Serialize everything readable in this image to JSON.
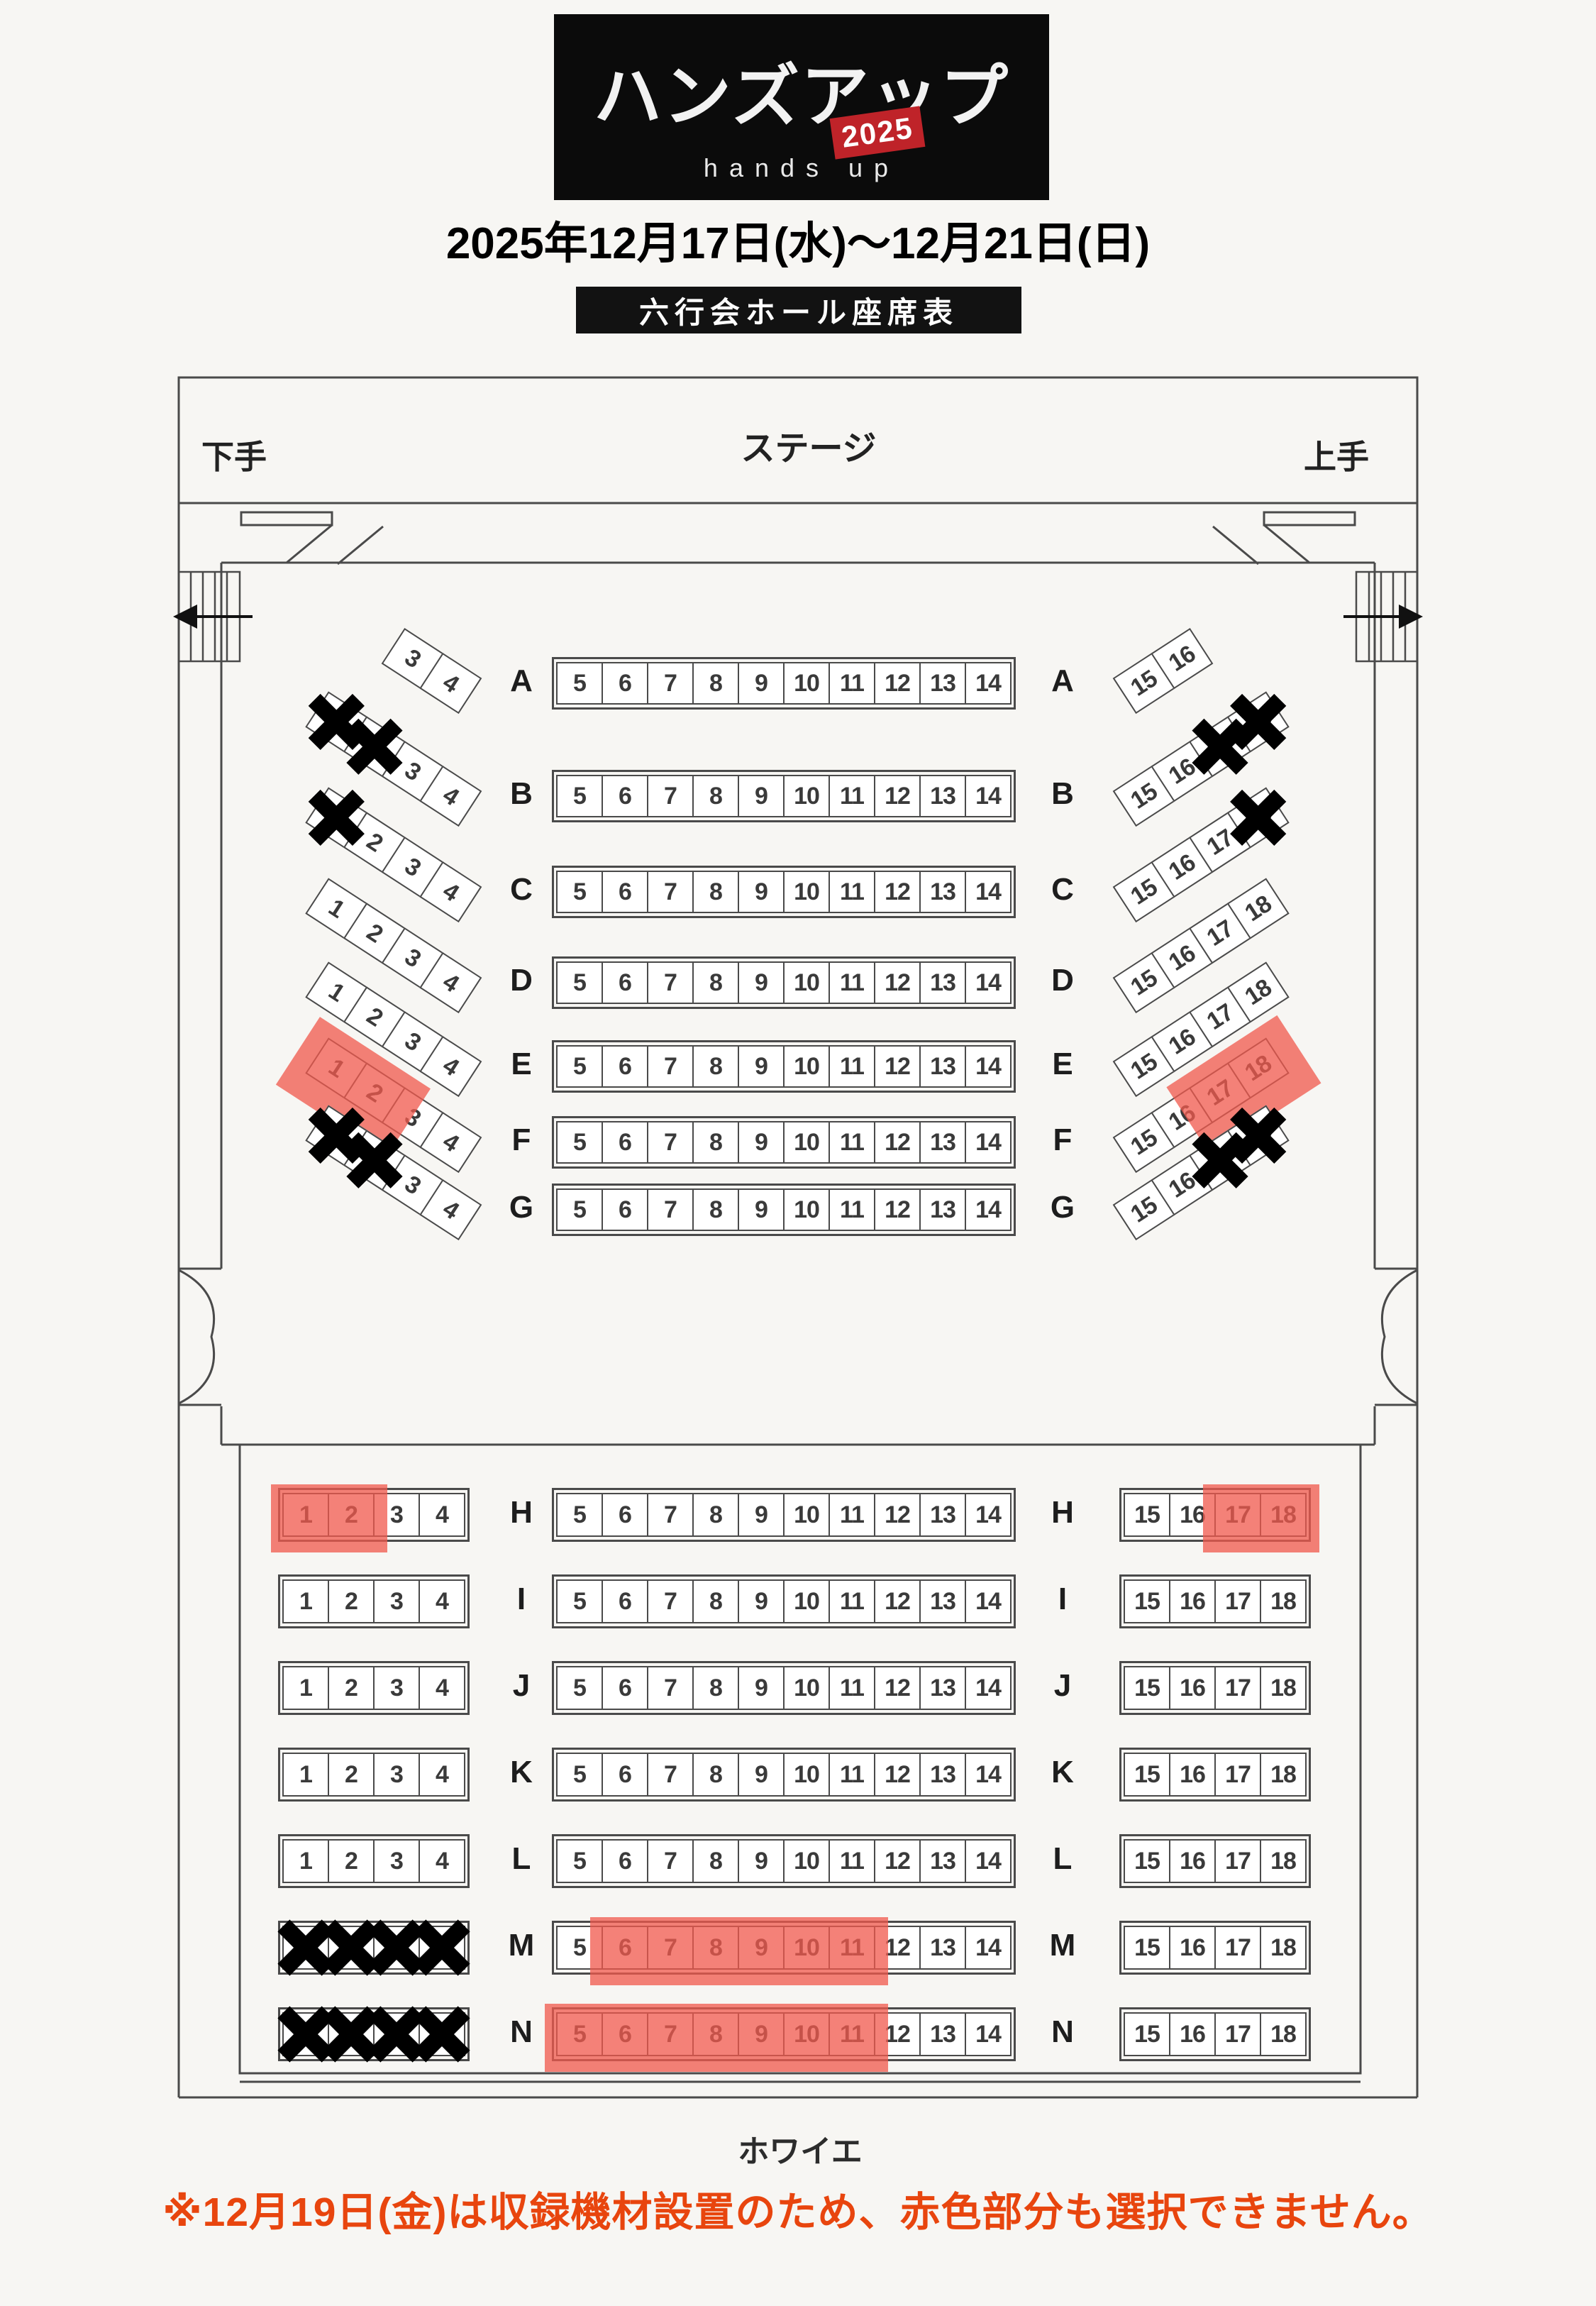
{
  "header": {
    "logo_title": "ハンズアップ",
    "logo_year": "2025",
    "logo_subtitle": "hands up",
    "dates": "2025年12月17日(水)〜12月21日(日)",
    "hall_banner": "六行会ホール座席表"
  },
  "stage": {
    "label": "ステージ",
    "left_wing": "下手",
    "right_wing": "上手"
  },
  "foyer_label": "ホワイエ",
  "note": "※12月19日(金)は収録機材設置のため、赤色部分も選択できません。",
  "colors": {
    "restricted_highlight": "#f05a4e",
    "note_text": "#e8450e",
    "badge_red": "#bf2329",
    "line": "#4a4a4a"
  },
  "icons": {
    "left_exit": "exit-arrow-left-icon",
    "right_exit": "exit-arrow-right-icon",
    "unavailable": "cross-x-icon"
  },
  "state_legend": {
    "o": "open",
    "x": "unavailable",
    "r": "restricted-on-12-19"
  },
  "sections": {
    "upper": {
      "rows": [
        {
          "label": "A",
          "left": [
            [
              "3",
              "o"
            ],
            [
              "4",
              "o"
            ]
          ],
          "center": [
            [
              "5",
              "o"
            ],
            [
              "6",
              "o"
            ],
            [
              "7",
              "o"
            ],
            [
              "8",
              "o"
            ],
            [
              "9",
              "o"
            ],
            [
              "10",
              "o"
            ],
            [
              "11",
              "o"
            ],
            [
              "12",
              "o"
            ],
            [
              "13",
              "o"
            ],
            [
              "14",
              "o"
            ]
          ],
          "right": [
            [
              "15",
              "o"
            ],
            [
              "16",
              "o"
            ]
          ]
        },
        {
          "label": "B",
          "left": [
            [
              "1",
              "x"
            ],
            [
              "2",
              "x"
            ],
            [
              "3",
              "o"
            ],
            [
              "4",
              "o"
            ]
          ],
          "center": [
            [
              "5",
              "o"
            ],
            [
              "6",
              "o"
            ],
            [
              "7",
              "o"
            ],
            [
              "8",
              "o"
            ],
            [
              "9",
              "o"
            ],
            [
              "10",
              "o"
            ],
            [
              "11",
              "o"
            ],
            [
              "12",
              "o"
            ],
            [
              "13",
              "o"
            ],
            [
              "14",
              "o"
            ]
          ],
          "right": [
            [
              "15",
              "o"
            ],
            [
              "16",
              "o"
            ],
            [
              "17",
              "x"
            ],
            [
              "18",
              "x"
            ]
          ]
        },
        {
          "label": "C",
          "left": [
            [
              "1",
              "x"
            ],
            [
              "2",
              "o"
            ],
            [
              "3",
              "o"
            ],
            [
              "4",
              "o"
            ]
          ],
          "center": [
            [
              "5",
              "o"
            ],
            [
              "6",
              "o"
            ],
            [
              "7",
              "o"
            ],
            [
              "8",
              "o"
            ],
            [
              "9",
              "o"
            ],
            [
              "10",
              "o"
            ],
            [
              "11",
              "o"
            ],
            [
              "12",
              "o"
            ],
            [
              "13",
              "o"
            ],
            [
              "14",
              "o"
            ]
          ],
          "right": [
            [
              "15",
              "o"
            ],
            [
              "16",
              "o"
            ],
            [
              "17",
              "o"
            ],
            [
              "18",
              "x"
            ]
          ]
        },
        {
          "label": "D",
          "left": [
            [
              "1",
              "o"
            ],
            [
              "2",
              "o"
            ],
            [
              "3",
              "o"
            ],
            [
              "4",
              "o"
            ]
          ],
          "center": [
            [
              "5",
              "o"
            ],
            [
              "6",
              "o"
            ],
            [
              "7",
              "o"
            ],
            [
              "8",
              "o"
            ],
            [
              "9",
              "o"
            ],
            [
              "10",
              "o"
            ],
            [
              "11",
              "o"
            ],
            [
              "12",
              "o"
            ],
            [
              "13",
              "o"
            ],
            [
              "14",
              "o"
            ]
          ],
          "right": [
            [
              "15",
              "o"
            ],
            [
              "16",
              "o"
            ],
            [
              "17",
              "o"
            ],
            [
              "18",
              "o"
            ]
          ]
        },
        {
          "label": "E",
          "left": [
            [
              "1",
              "o"
            ],
            [
              "2",
              "o"
            ],
            [
              "3",
              "o"
            ],
            [
              "4",
              "o"
            ]
          ],
          "center": [
            [
              "5",
              "o"
            ],
            [
              "6",
              "o"
            ],
            [
              "7",
              "o"
            ],
            [
              "8",
              "o"
            ],
            [
              "9",
              "o"
            ],
            [
              "10",
              "o"
            ],
            [
              "11",
              "o"
            ],
            [
              "12",
              "o"
            ],
            [
              "13",
              "o"
            ],
            [
              "14",
              "o"
            ]
          ],
          "right": [
            [
              "15",
              "o"
            ],
            [
              "16",
              "o"
            ],
            [
              "17",
              "o"
            ],
            [
              "18",
              "o"
            ]
          ]
        },
        {
          "label": "F",
          "left": [
            [
              "1",
              "r"
            ],
            [
              "2",
              "r"
            ],
            [
              "3",
              "o"
            ],
            [
              "4",
              "o"
            ]
          ],
          "center": [
            [
              "5",
              "o"
            ],
            [
              "6",
              "o"
            ],
            [
              "7",
              "o"
            ],
            [
              "8",
              "o"
            ],
            [
              "9",
              "o"
            ],
            [
              "10",
              "o"
            ],
            [
              "11",
              "o"
            ],
            [
              "12",
              "o"
            ],
            [
              "13",
              "o"
            ],
            [
              "14",
              "o"
            ]
          ],
          "right": [
            [
              "15",
              "o"
            ],
            [
              "16",
              "o"
            ],
            [
              "17",
              "r"
            ],
            [
              "18",
              "r"
            ]
          ]
        },
        {
          "label": "G",
          "left": [
            [
              "1",
              "x"
            ],
            [
              "2",
              "x"
            ],
            [
              "3",
              "o"
            ],
            [
              "4",
              "o"
            ]
          ],
          "center": [
            [
              "5",
              "o"
            ],
            [
              "6",
              "o"
            ],
            [
              "7",
              "o"
            ],
            [
              "8",
              "o"
            ],
            [
              "9",
              "o"
            ],
            [
              "10",
              "o"
            ],
            [
              "11",
              "o"
            ],
            [
              "12",
              "o"
            ],
            [
              "13",
              "o"
            ],
            [
              "14",
              "o"
            ]
          ],
          "right": [
            [
              "15",
              "o"
            ],
            [
              "16",
              "o"
            ],
            [
              "17",
              "x"
            ],
            [
              "18",
              "x"
            ]
          ]
        }
      ]
    },
    "lower": {
      "rows": [
        {
          "label": "H",
          "left": [
            [
              "1",
              "r"
            ],
            [
              "2",
              "r"
            ],
            [
              "3",
              "o"
            ],
            [
              "4",
              "o"
            ]
          ],
          "center": [
            [
              "5",
              "o"
            ],
            [
              "6",
              "o"
            ],
            [
              "7",
              "o"
            ],
            [
              "8",
              "o"
            ],
            [
              "9",
              "o"
            ],
            [
              "10",
              "o"
            ],
            [
              "11",
              "o"
            ],
            [
              "12",
              "o"
            ],
            [
              "13",
              "o"
            ],
            [
              "14",
              "o"
            ]
          ],
          "right": [
            [
              "15",
              "o"
            ],
            [
              "16",
              "o"
            ],
            [
              "17",
              "r"
            ],
            [
              "18",
              "r"
            ]
          ]
        },
        {
          "label": "I",
          "left": [
            [
              "1",
              "o"
            ],
            [
              "2",
              "o"
            ],
            [
              "3",
              "o"
            ],
            [
              "4",
              "o"
            ]
          ],
          "center": [
            [
              "5",
              "o"
            ],
            [
              "6",
              "o"
            ],
            [
              "7",
              "o"
            ],
            [
              "8",
              "o"
            ],
            [
              "9",
              "o"
            ],
            [
              "10",
              "o"
            ],
            [
              "11",
              "o"
            ],
            [
              "12",
              "o"
            ],
            [
              "13",
              "o"
            ],
            [
              "14",
              "o"
            ]
          ],
          "right": [
            [
              "15",
              "o"
            ],
            [
              "16",
              "o"
            ],
            [
              "17",
              "o"
            ],
            [
              "18",
              "o"
            ]
          ]
        },
        {
          "label": "J",
          "left": [
            [
              "1",
              "o"
            ],
            [
              "2",
              "o"
            ],
            [
              "3",
              "o"
            ],
            [
              "4",
              "o"
            ]
          ],
          "center": [
            [
              "5",
              "o"
            ],
            [
              "6",
              "o"
            ],
            [
              "7",
              "o"
            ],
            [
              "8",
              "o"
            ],
            [
              "9",
              "o"
            ],
            [
              "10",
              "o"
            ],
            [
              "11",
              "o"
            ],
            [
              "12",
              "o"
            ],
            [
              "13",
              "o"
            ],
            [
              "14",
              "o"
            ]
          ],
          "right": [
            [
              "15",
              "o"
            ],
            [
              "16",
              "o"
            ],
            [
              "17",
              "o"
            ],
            [
              "18",
              "o"
            ]
          ]
        },
        {
          "label": "K",
          "left": [
            [
              "1",
              "o"
            ],
            [
              "2",
              "o"
            ],
            [
              "3",
              "o"
            ],
            [
              "4",
              "o"
            ]
          ],
          "center": [
            [
              "5",
              "o"
            ],
            [
              "6",
              "o"
            ],
            [
              "7",
              "o"
            ],
            [
              "8",
              "o"
            ],
            [
              "9",
              "o"
            ],
            [
              "10",
              "o"
            ],
            [
              "11",
              "o"
            ],
            [
              "12",
              "o"
            ],
            [
              "13",
              "o"
            ],
            [
              "14",
              "o"
            ]
          ],
          "right": [
            [
              "15",
              "o"
            ],
            [
              "16",
              "o"
            ],
            [
              "17",
              "o"
            ],
            [
              "18",
              "o"
            ]
          ]
        },
        {
          "label": "L",
          "left": [
            [
              "1",
              "o"
            ],
            [
              "2",
              "o"
            ],
            [
              "3",
              "o"
            ],
            [
              "4",
              "o"
            ]
          ],
          "center": [
            [
              "5",
              "o"
            ],
            [
              "6",
              "o"
            ],
            [
              "7",
              "o"
            ],
            [
              "8",
              "o"
            ],
            [
              "9",
              "o"
            ],
            [
              "10",
              "o"
            ],
            [
              "11",
              "o"
            ],
            [
              "12",
              "o"
            ],
            [
              "13",
              "o"
            ],
            [
              "14",
              "o"
            ]
          ],
          "right": [
            [
              "15",
              "o"
            ],
            [
              "16",
              "o"
            ],
            [
              "17",
              "o"
            ],
            [
              "18",
              "o"
            ]
          ]
        },
        {
          "label": "M",
          "left": [
            [
              "1",
              "x"
            ],
            [
              "2",
              "x"
            ],
            [
              "3",
              "x"
            ],
            [
              "4",
              "x"
            ]
          ],
          "center": [
            [
              "5",
              "o"
            ],
            [
              "6",
              "r"
            ],
            [
              "7",
              "r"
            ],
            [
              "8",
              "r"
            ],
            [
              "9",
              "r"
            ],
            [
              "10",
              "r"
            ],
            [
              "11",
              "r"
            ],
            [
              "12",
              "o"
            ],
            [
              "13",
              "o"
            ],
            [
              "14",
              "o"
            ]
          ],
          "right": [
            [
              "15",
              "o"
            ],
            [
              "16",
              "o"
            ],
            [
              "17",
              "o"
            ],
            [
              "18",
              "o"
            ]
          ]
        },
        {
          "label": "N",
          "left": [
            [
              "1",
              "x"
            ],
            [
              "2",
              "x"
            ],
            [
              "3",
              "x"
            ],
            [
              "4",
              "x"
            ]
          ],
          "center": [
            [
              "5",
              "r"
            ],
            [
              "6",
              "r"
            ],
            [
              "7",
              "r"
            ],
            [
              "8",
              "r"
            ],
            [
              "9",
              "r"
            ],
            [
              "10",
              "r"
            ],
            [
              "11",
              "r"
            ],
            [
              "12",
              "o"
            ],
            [
              "13",
              "o"
            ],
            [
              "14",
              "o"
            ]
          ],
          "right": [
            [
              "15",
              "o"
            ],
            [
              "16",
              "o"
            ],
            [
              "17",
              "o"
            ],
            [
              "18",
              "o"
            ]
          ]
        }
      ]
    }
  }
}
